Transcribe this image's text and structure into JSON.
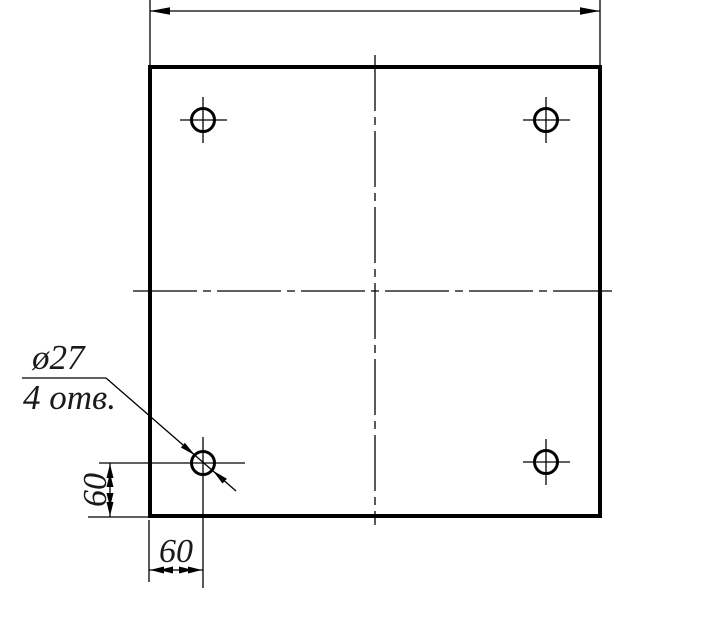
{
  "drawing": {
    "type": "engineering-drawing",
    "part": "square plate with 4 corner holes",
    "callout": {
      "diameter_label": "ø27",
      "holes_count_label": "4 отв."
    },
    "dimensions": {
      "left_vertical": "60",
      "bottom_horizontal": "60",
      "top_overall": ""
    },
    "colors": {
      "ink": "#000000",
      "paper": "#ffffff"
    }
  }
}
